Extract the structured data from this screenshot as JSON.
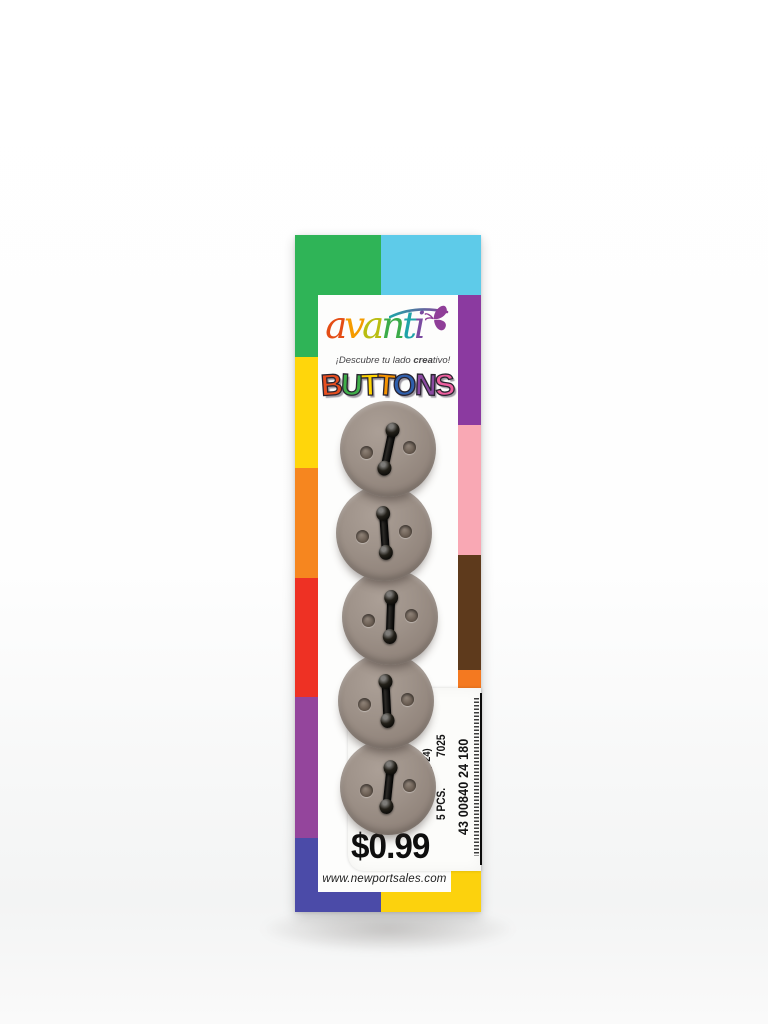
{
  "brand": {
    "logo_letters": [
      {
        "ch": "a",
        "color": "#e44d15"
      },
      {
        "ch": "v",
        "color": "#f59b00"
      },
      {
        "ch": "a",
        "color": "#b9bd12"
      },
      {
        "ch": "n",
        "color": "#3cab49"
      },
      {
        "ch": "t",
        "color": "#1fa3a8"
      },
      {
        "ch": "i",
        "color": "#7a4ba0"
      }
    ],
    "butterfly_color": "#8f3e98",
    "tagline": {
      "prefix": "¡Descubre tu lado ",
      "bold": "crea",
      "suffix": "tivo!"
    }
  },
  "title": {
    "word": "BUTTONS",
    "letters": [
      {
        "ch": "B",
        "color": "#e84e1f",
        "rot": -4
      },
      {
        "ch": "U",
        "color": "#3fae49",
        "rot": 3
      },
      {
        "ch": "T",
        "color": "#ffd400",
        "rot": -2
      },
      {
        "ch": "T",
        "color": "#f59300",
        "rot": 4
      },
      {
        "ch": "O",
        "color": "#2f5fac",
        "rot": -3
      },
      {
        "ch": "N",
        "color": "#8a4aa0",
        "rot": 2
      },
      {
        "ch": "S",
        "color": "#ef5f9f",
        "rot": -5
      }
    ]
  },
  "buttons": {
    "count": 5,
    "color": "#9d9188",
    "items": [
      {
        "cx": 388,
        "cy": 449,
        "d": 96,
        "tilt": 12
      },
      {
        "cx": 384,
        "cy": 533,
        "d": 96,
        "tilt": -4
      },
      {
        "cx": 390,
        "cy": 617,
        "d": 96,
        "tilt": 2
      },
      {
        "cx": 386,
        "cy": 701,
        "d": 96,
        "tilt": -3
      },
      {
        "cx": 388,
        "cy": 787,
        "d": 96,
        "tilt": 6
      }
    ]
  },
  "sticker": {
    "desc": "(#24)",
    "style_no": "7025",
    "qty": "5 PCS.",
    "barcode_number": "43 00840 24 180",
    "price": "$0.99"
  },
  "footer": {
    "website": "www.newportsales.com"
  },
  "border_blocks": [
    {
      "name": "top-green",
      "color": "#2fb457",
      "x": 0,
      "y": 0,
      "w": 86,
      "h": 60
    },
    {
      "name": "top-cyan",
      "color": "#5ecbe9",
      "x": 86,
      "y": 0,
      "w": 100,
      "h": 60
    },
    {
      "name": "left-green",
      "color": "#2fb457",
      "x": 0,
      "y": 60,
      "w": 23,
      "h": 62
    },
    {
      "name": "left-yellow",
      "color": "#ffd60b",
      "x": 0,
      "y": 122,
      "w": 23,
      "h": 111
    },
    {
      "name": "left-orange",
      "color": "#f6861f",
      "x": 0,
      "y": 233,
      "w": 23,
      "h": 110
    },
    {
      "name": "left-red",
      "color": "#ee3124",
      "x": 0,
      "y": 343,
      "w": 23,
      "h": 119
    },
    {
      "name": "left-purple",
      "color": "#94459c",
      "x": 0,
      "y": 462,
      "w": 23,
      "h": 141
    },
    {
      "name": "left-indigo",
      "color": "#4b4ba8",
      "x": 0,
      "y": 603,
      "w": 23,
      "h": 74
    },
    {
      "name": "right-purple",
      "color": "#8b3aa0",
      "x": 163,
      "y": 60,
      "w": 23,
      "h": 130
    },
    {
      "name": "right-pink",
      "color": "#f9a8b4",
      "x": 163,
      "y": 190,
      "w": 23,
      "h": 130
    },
    {
      "name": "right-brown",
      "color": "#5e3a1c",
      "x": 163,
      "y": 320,
      "w": 23,
      "h": 115
    },
    {
      "name": "right-orange",
      "color": "#f47920",
      "x": 163,
      "y": 435,
      "w": 23,
      "h": 50
    },
    {
      "name": "right-yellow",
      "color": "#fcd20d",
      "x": 156,
      "y": 636,
      "w": 30,
      "h": 41
    },
    {
      "name": "bottom-indigo",
      "color": "#4b4ba8",
      "x": 0,
      "y": 657,
      "w": 86,
      "h": 20
    },
    {
      "name": "bottom-yellow",
      "color": "#fcd20d",
      "x": 86,
      "y": 657,
      "w": 100,
      "h": 20
    }
  ]
}
